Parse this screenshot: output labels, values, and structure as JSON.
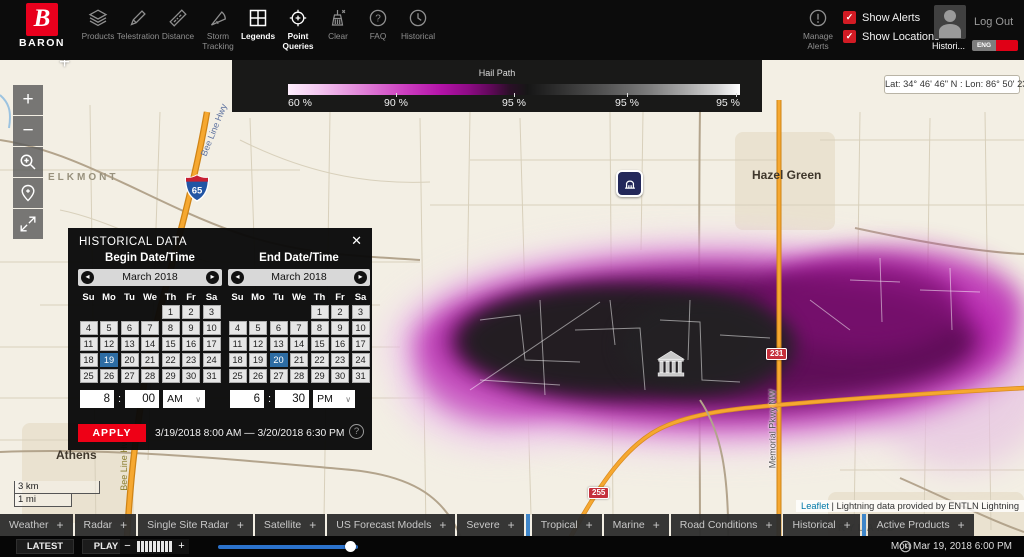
{
  "toolbar": {
    "brand_letter": "B",
    "brand": "BARON",
    "items": [
      {
        "label": "Products",
        "icon": "layers-icon",
        "active": false
      },
      {
        "label": "Telestration",
        "icon": "pencil-icon",
        "active": false
      },
      {
        "label": "Distance",
        "icon": "ruler-icon",
        "active": false
      },
      {
        "label": "Storm Tracking",
        "icon": "storm-cone-icon",
        "active": false
      },
      {
        "label": "Legends",
        "icon": "legend-grid-icon",
        "active": true
      },
      {
        "label": "Point Queries",
        "icon": "crosshair-icon",
        "active": true
      },
      {
        "label": "Clear",
        "icon": "broom-icon",
        "active": false
      },
      {
        "label": "FAQ",
        "icon": "question-icon",
        "active": false
      },
      {
        "label": "Historical",
        "icon": "clock-icon",
        "active": false
      }
    ],
    "faq_glyph": "?",
    "manage_alerts_label": "Manage Alerts",
    "check_glyph": "✓",
    "checkboxes": [
      {
        "label": "Show Alerts",
        "checked": true
      },
      {
        "label": "Show Locations",
        "checked": true
      }
    ],
    "user_label": "Histori...",
    "lang_toggle": "ENG",
    "logout_label": "Log Out"
  },
  "legend": {
    "title": "Hail Path",
    "labels": [
      "60 %",
      "90 %",
      "95 %",
      "95 %",
      "95 %"
    ]
  },
  "map": {
    "coords": "Lat: 34° 46' 46\" N : Lon: 86° 50' 23\" W",
    "crosshair": "+",
    "controls": {
      "zoom_in": "+",
      "zoom_out": "−"
    },
    "labels": {
      "elkmont": "ELKMONT",
      "hazel_green": "Hazel Green",
      "athens": "Athens",
      "ryland": "RYLAND",
      "bee_line_hwy_north": "Bee Line Hwy",
      "bee_line_hwy_south": "Bee Line Hwy",
      "memorial_pkwy": "Memorial Pkwy NW"
    },
    "shields": {
      "i65": "65",
      "us231": "231",
      "al255": "255"
    },
    "scale": {
      "km": "3 km",
      "mi": "1 mi"
    },
    "attribution": {
      "link": "Leaflet",
      "text": "| Lightning data provided by ENTLN Lightning"
    }
  },
  "dialog": {
    "title": "HISTORICAL DATA",
    "close_glyph": "✕",
    "prev_glyph": "◂",
    "next_glyph": "▸",
    "day_headers": [
      "Su",
      "Mo",
      "Tu",
      "We",
      "Th",
      "Fr",
      "Sa"
    ],
    "weeks": [
      [
        "",
        "",
        "",
        "",
        "1",
        "2",
        "3"
      ],
      [
        "4",
        "5",
        "6",
        "7",
        "8",
        "9",
        "10"
      ],
      [
        "11",
        "12",
        "13",
        "14",
        "15",
        "16",
        "17"
      ],
      [
        "18",
        "19",
        "20",
        "21",
        "22",
        "23",
        "24"
      ],
      [
        "25",
        "26",
        "27",
        "28",
        "29",
        "30",
        "31"
      ]
    ],
    "time_separator": ":",
    "caret": "∨",
    "begin": {
      "header": "Begin Date/Time",
      "month": "March 2018",
      "selected": 19,
      "hour": "8",
      "minute": "00",
      "meridiem": "AM"
    },
    "end": {
      "header": "End Date/Time",
      "month": "March 2018",
      "selected": 20,
      "hour": "6",
      "minute": "30",
      "meridiem": "PM"
    },
    "apply_label": "APPLY",
    "range_text": "3/19/2018 8:00 AM — 3/20/2018 6:30 PM",
    "help_glyph": "?"
  },
  "tabs": {
    "add_symbol": "+",
    "items": [
      {
        "label": "Weather"
      },
      {
        "label": "Radar"
      },
      {
        "label": "Single Site Radar"
      },
      {
        "label": "Satellite"
      },
      {
        "label": "US Forecast Models"
      },
      {
        "label": "Severe"
      },
      {
        "label": "Tropical"
      },
      {
        "label": "Marine"
      },
      {
        "label": "Road Conditions"
      },
      {
        "label": "Historical"
      },
      {
        "label": "Active Products"
      }
    ]
  },
  "statusbar": {
    "latest": "LATEST",
    "play": "PLAY",
    "slower": "−",
    "faster": "+",
    "bar_count": 9,
    "timestamp": "Mon Mar 19, 2018 6:00 PM"
  },
  "colors": {
    "accent_red": "#e8001d",
    "selection_blue": "#2d6ca3",
    "slider_blue": "#2b72cc",
    "tab_sep_blue": "#3f86c9",
    "hail_magenta": "#b824b0"
  }
}
